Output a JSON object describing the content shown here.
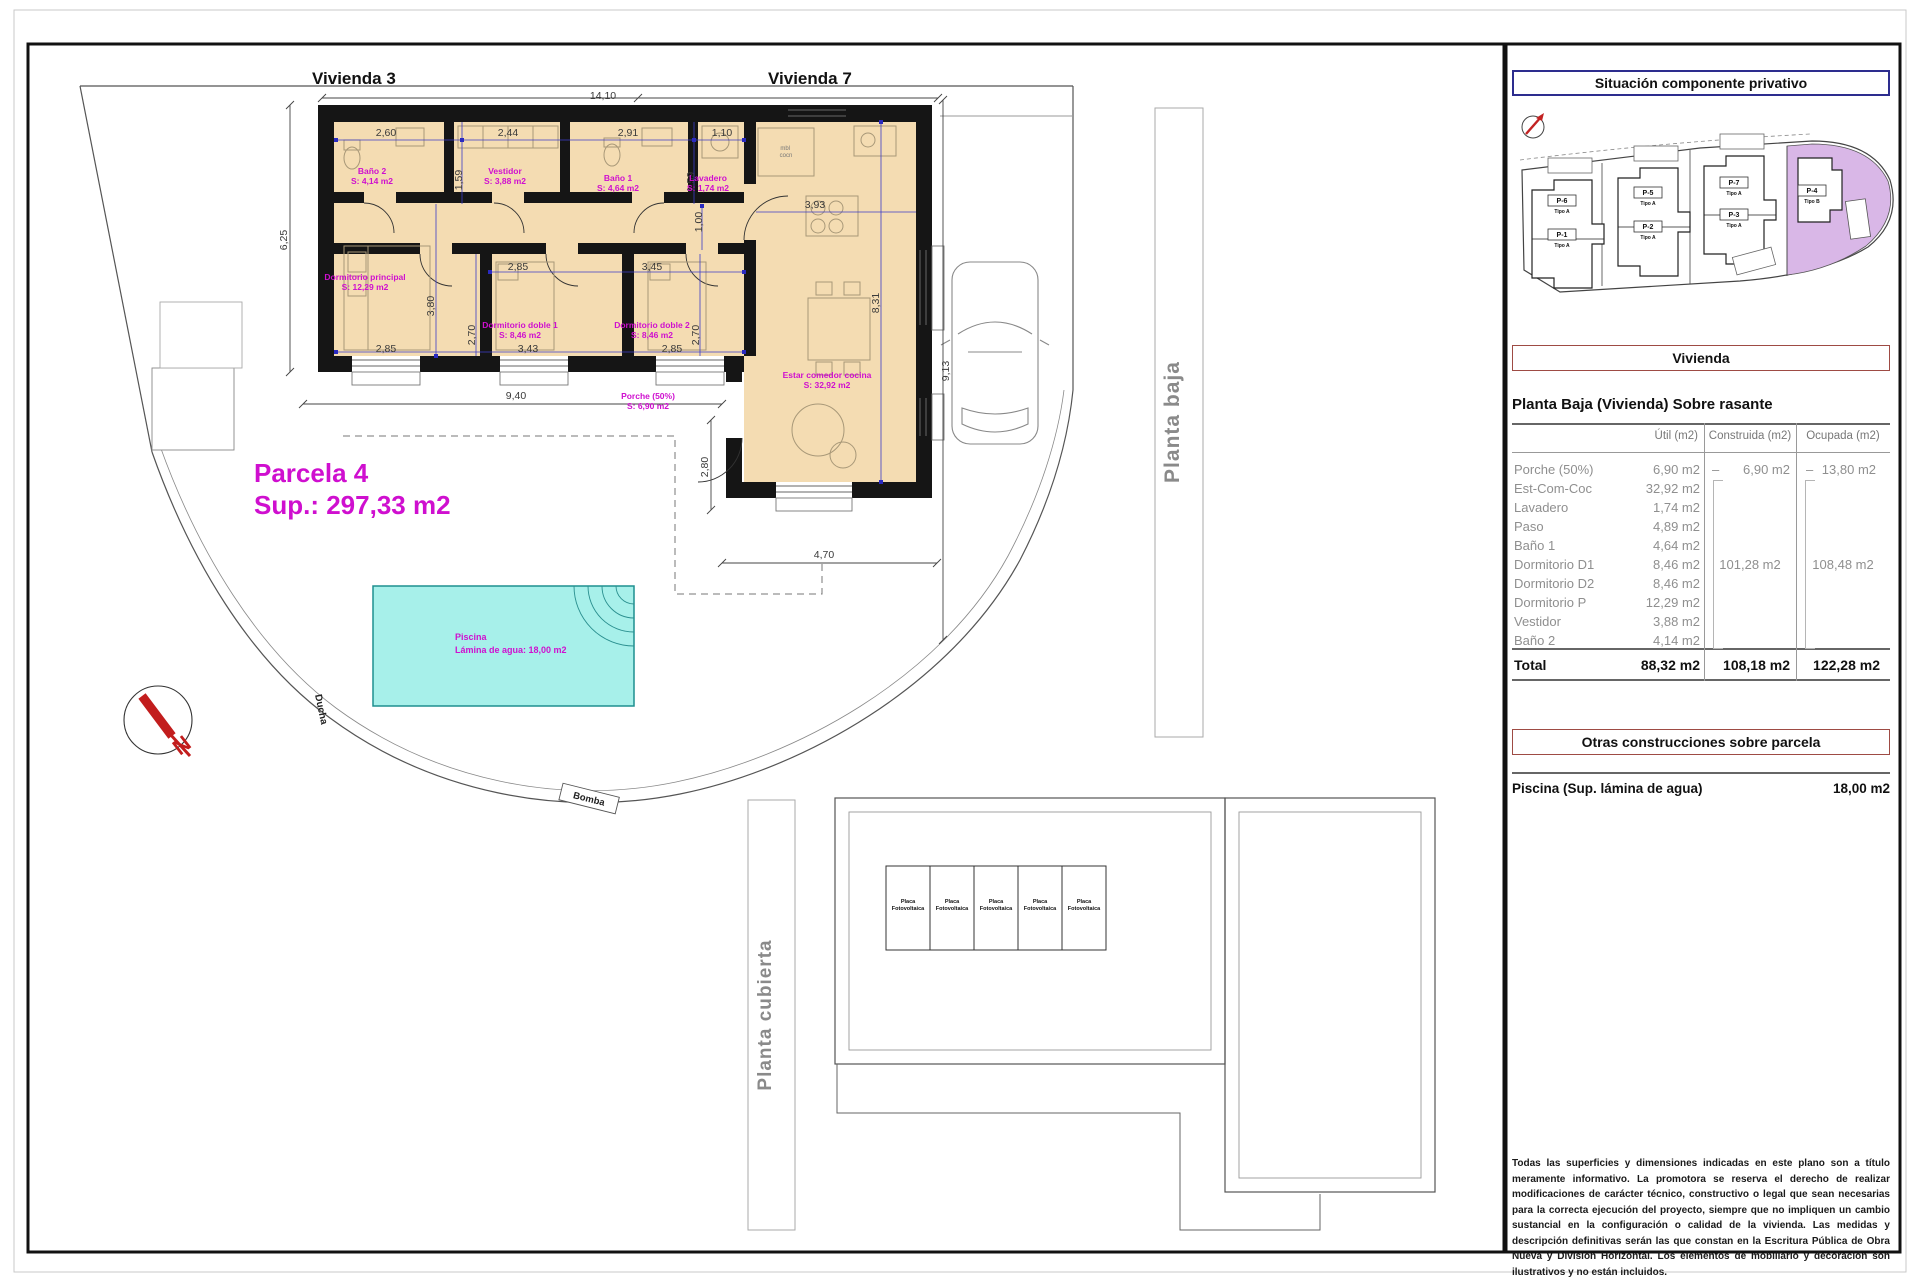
{
  "plan": {
    "vivienda3": "Vivienda 3",
    "vivienda7": "Vivienda 7",
    "parcela": {
      "title": "Parcela 4",
      "area": "Sup.: 297,33 m2"
    },
    "rooms": [
      {
        "name": "Baño 2",
        "area": "S: 4,14 m2"
      },
      {
        "name": "Vestidor",
        "area": "S: 3,88 m2"
      },
      {
        "name": "Baño 1",
        "area": "S: 4,64 m2"
      },
      {
        "name": "Lavadero",
        "area": "S: 1,74 m2"
      },
      {
        "name": "Dormitorio principal",
        "area": "S: 12,29 m2"
      },
      {
        "name": "Dormitorio doble 1",
        "area": "S: 8,46 m2"
      },
      {
        "name": "Dormitorio doble 2",
        "area": "S: 8,46 m2"
      },
      {
        "name": "Estar comedor cocina",
        "area": "S: 32,92 m2"
      },
      {
        "name": "Porche (50%)",
        "area": "S: 6,90 m2"
      }
    ],
    "pool": {
      "line1": "Piscina",
      "line2": "Lámina de agua: 18,00 m2"
    },
    "kitchen_note": [
      "mbl",
      "cocn"
    ],
    "ducha": "Ducha",
    "bomba": "Bomba",
    "north": "N",
    "dimensions": [
      "14,10",
      "6,25",
      "2,60",
      "2,44",
      "2,91",
      "1,10",
      "1,59",
      "1,59",
      "3,93",
      "1,00",
      "2,85",
      "3,45",
      "3,80",
      "2,70",
      "2,70",
      "8,31",
      "9,13",
      "2,85",
      "3,43",
      "2,85",
      "9,40",
      "2,80",
      "4,70"
    ],
    "planta_baja": "Planta baja",
    "planta_cubierta": "Planta cubierta",
    "placa_line1": "Placa",
    "placa_line2": "Fotovoltaica",
    "placa_count": 5
  },
  "panel": {
    "situacion_title": "Situación componente privativo",
    "plots": [
      {
        "code": "P-6",
        "tipo": "Tipo A"
      },
      {
        "code": "P-1",
        "tipo": "Tipo A"
      },
      {
        "code": "P-5",
        "tipo": "Tipo A"
      },
      {
        "code": "P-2",
        "tipo": "Tipo A"
      },
      {
        "code": "P-7",
        "tipo": "Tipo A"
      },
      {
        "code": "P-3",
        "tipo": "Tipo A"
      },
      {
        "code": "P-4",
        "tipo": "Tipo B"
      }
    ],
    "vivienda_title": "Vivienda",
    "table_title": "Planta Baja (Vivienda) Sobre rasante",
    "table": {
      "headers": [
        "Útil (m2)",
        "Construida (m2)",
        "Ocupada (m2)"
      ],
      "rows": [
        {
          "label": "Porche (50%)",
          "util": "6,90 m2",
          "c_dash": "–",
          "c_val": "6,90 m2",
          "o_dash": "–",
          "o_val": "13,80 m2"
        },
        {
          "label": "Est-Com-Coc",
          "util": "32,92 m2"
        },
        {
          "label": "Lavadero",
          "util": "1,74 m2"
        },
        {
          "label": "Paso",
          "util": "4,89 m2"
        },
        {
          "label": "Baño 1",
          "util": "4,64 m2"
        },
        {
          "label": "Dormitorio D1",
          "util": "8,46 m2"
        },
        {
          "label": "Dormitorio D2",
          "util": "8,46 m2"
        },
        {
          "label": "Dormitorio P",
          "util": "12,29 m2"
        },
        {
          "label": "Vestidor",
          "util": "3,88 m2"
        },
        {
          "label": "Baño 2",
          "util": "4,14 m2"
        }
      ],
      "group_construida": "101,28 m2",
      "group_ocupada": "108,48 m2",
      "total": {
        "label": "Total",
        "util": "88,32 m2",
        "construida": "108,18 m2",
        "ocupada": "122,28 m2"
      }
    },
    "otras_title": "Otras construcciones sobre parcela",
    "piscina_label": "Piscina (Sup. lámina de agua)",
    "piscina_value": "18,00 m2",
    "disclaimer": "Todas las superficies y dimensiones indicadas en este plano son a título meramente informativo. La promotora se reserva el derecho de realizar modificaciones de carácter técnico, constructivo o legal que sean necesarias para la correcta ejecución del proyecto, siempre que no impliquen un cambio sustancial en la configuración o calidad de la vivienda. Las medidas y descripción definitivas serán las que constan en la Escritura Pública de Obra Nueva y División Horizontal. Los elementos de mobiliario y decoración son ilustrativos y no están incluidos."
  },
  "colors": {
    "magenta": "#cf0fcf",
    "dim_blue": "#3c3cc8",
    "pool_fill": "#a7f0ea",
    "site_purple": "#d9b7e7",
    "box_navy": "#2d2d8e",
    "box_red": "#9e4b44"
  }
}
